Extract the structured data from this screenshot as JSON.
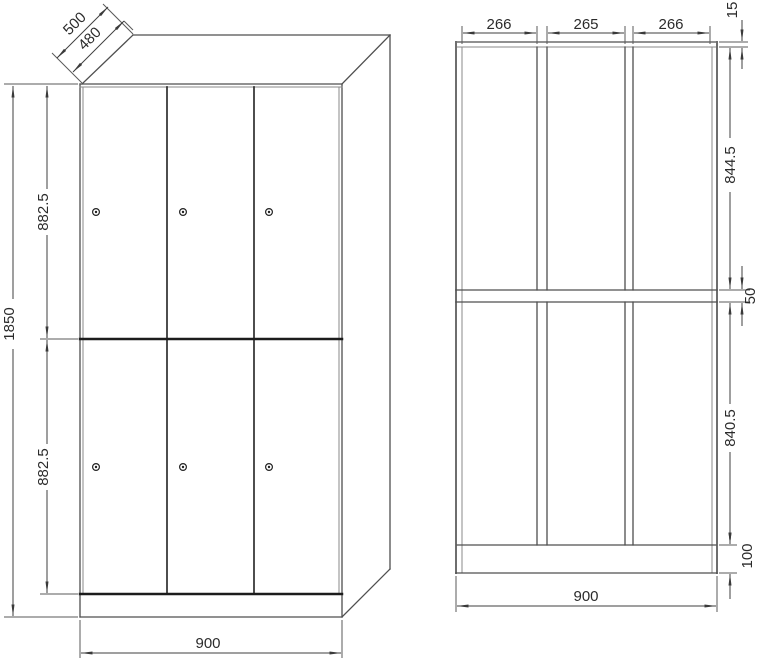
{
  "drawing": {
    "front_view": {
      "depth_outer": "500",
      "depth_inner": "480",
      "height_total": "1850",
      "upper_door_height": "882.5",
      "lower_door_height": "882.5",
      "width": "900"
    },
    "section_view": {
      "compartment_left": "266",
      "compartment_middle": "265",
      "compartment_right": "266",
      "top_panel_thickness": "15",
      "upper_compartment_height": "844.5",
      "shelf_thickness": "50",
      "lower_compartment_height": "840.5",
      "plinth_height": "100",
      "width": "900"
    },
    "colors": {
      "background": "#ffffff",
      "outline": "#4f4f4f",
      "outline_dark": "#1c1c1c",
      "dimension": "#3f3f3f",
      "text": "#2b2b2b"
    }
  }
}
